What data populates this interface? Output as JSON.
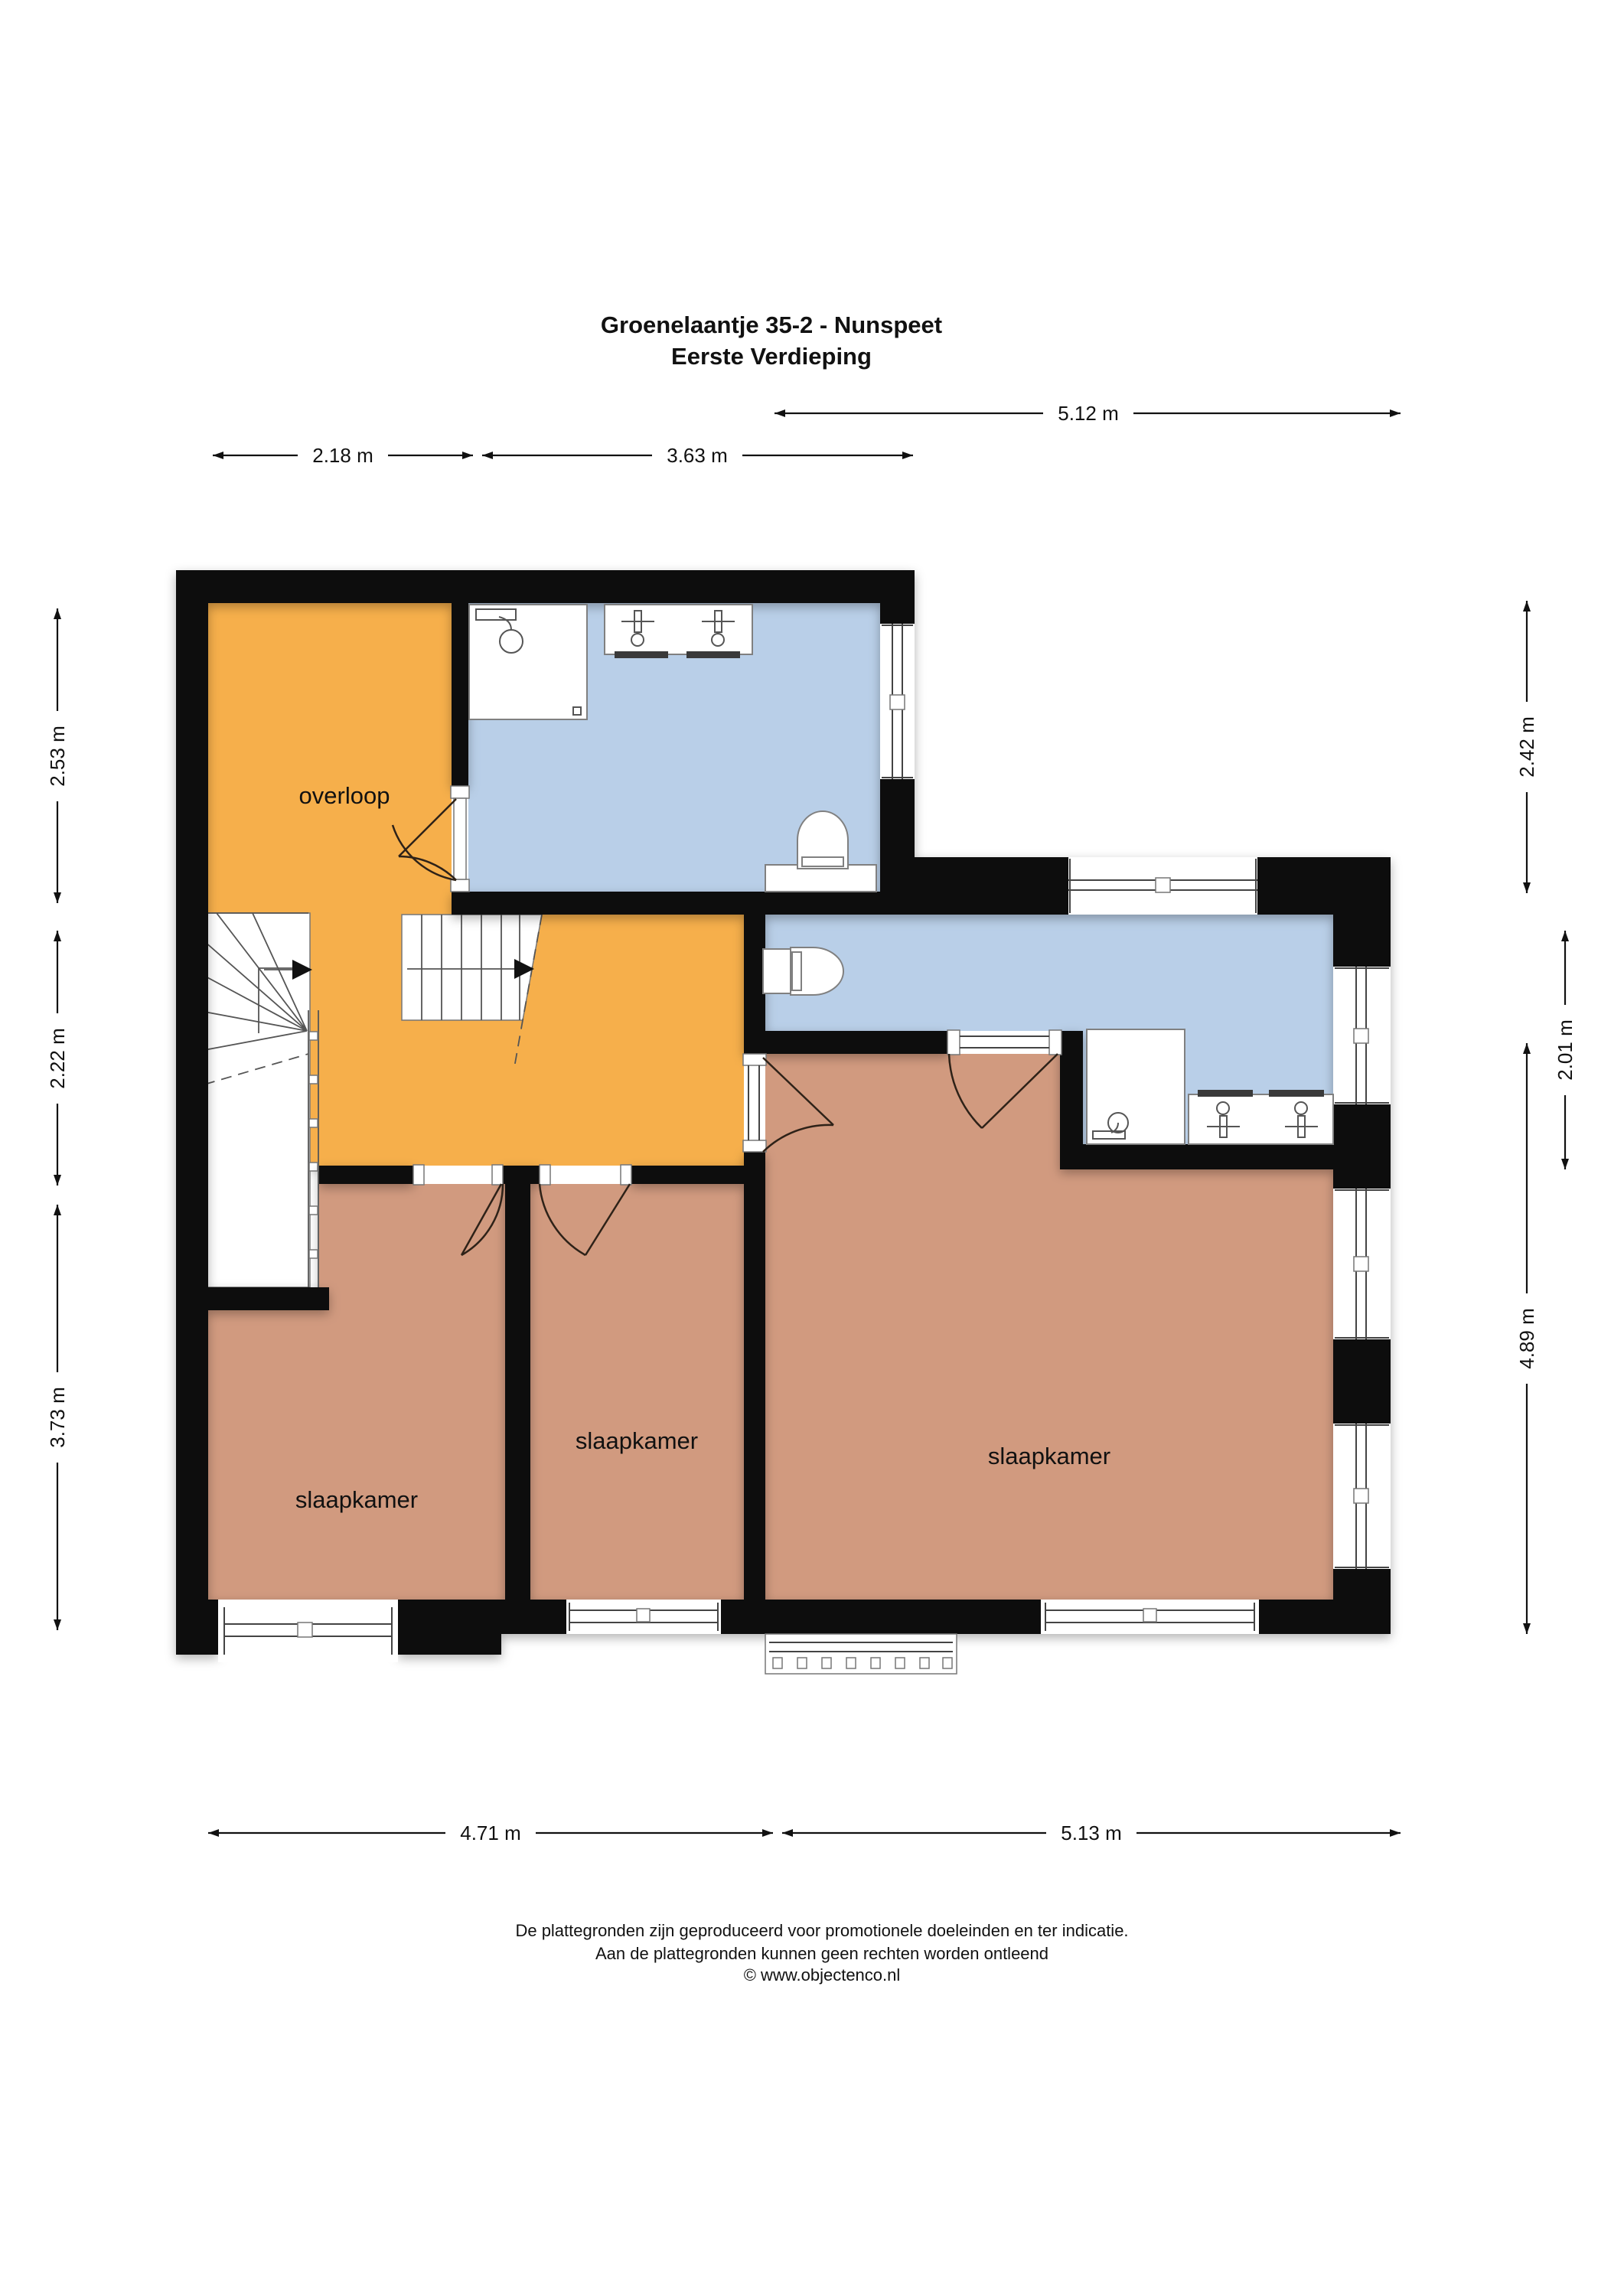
{
  "title": {
    "line1": "Groenelaantje 35-2 - Nunspeet",
    "line2": "Eerste Verdieping"
  },
  "rooms": {
    "overloop": "overloop",
    "bedroom1": "slaapkamer",
    "bedroom2": "slaapkamer",
    "bedroom3": "slaapkamer"
  },
  "dimensions": {
    "top_right": "5.12 m",
    "top_left_1": "2.18 m",
    "top_left_2": "3.63 m",
    "left_1": "2.53 m",
    "left_2": "2.22 m",
    "left_3": "3.73 m",
    "right_1": "2.42 m",
    "right_2": "2.01 m",
    "right_3": "4.89 m",
    "bottom_1": "4.71 m",
    "bottom_2": "5.13 m"
  },
  "footer": {
    "line1": "De plattegronden zijn geproduceerd voor promotionele doeleinden en ter indicatie.",
    "line2": "Aan de plattegronden kunnen geen rechten worden ontleend",
    "line3": "© www.objectenco.nl"
  },
  "colors": {
    "hall": "#F6AF4C",
    "bath": "#B9CFE8",
    "bedroom": "#D19A7F",
    "wall": "#0D0D0D"
  }
}
